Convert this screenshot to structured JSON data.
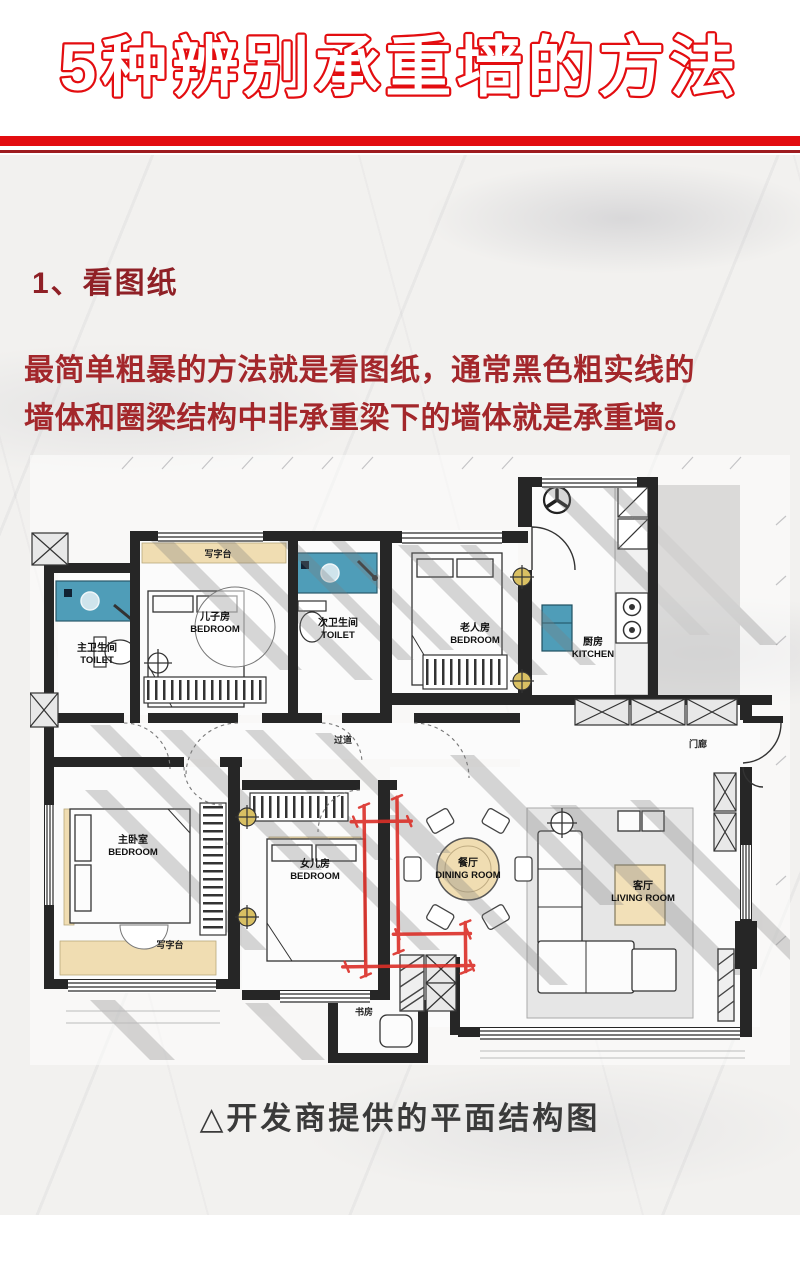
{
  "header": {
    "title": "5种辨别承重墙的方法"
  },
  "section": {
    "heading": "1、看图纸",
    "body_line1": "最简单粗暴的方法就是看图纸，通常黑色粗实线的",
    "body_line2": "墙体和圈梁结构中非承重梁下的墙体就是承重墙。",
    "caption": "△开发商提供的平面结构图"
  },
  "colors": {
    "accent_red": "#e30d10",
    "divider_dark_red": "#9e1c20",
    "heading_red": "#8f2026",
    "body_red": "#a3272b",
    "caption_gray": "#3a3a3a",
    "plan_wall_black": "#262626",
    "plan_fixture_blue": "#4f9db8",
    "plan_wood_tan": "#f0ddb2",
    "annotation_red": "#db2f28"
  },
  "floorplan": {
    "rooms": {
      "toilet_master": {
        "zh": "主卫生间",
        "en": "TOILET"
      },
      "bedroom_son": {
        "zh": "儿子房",
        "en": "BEDROOM"
      },
      "toilet_second": {
        "zh": "次卫生间",
        "en": "TOILET"
      },
      "bedroom_elder": {
        "zh": "老人房",
        "en": "BEDROOM"
      },
      "kitchen": {
        "zh": "厨房",
        "en": "KITCHEN"
      },
      "bedroom_master": {
        "zh": "主卧室",
        "en": "BEDROOM"
      },
      "bedroom_daughter": {
        "zh": "女儿房",
        "en": "BEDROOM"
      },
      "dining": {
        "zh": "餐厅",
        "en": "DINING ROOM"
      },
      "living": {
        "zh": "客厅",
        "en": "LIVING ROOM"
      }
    },
    "annotations": {
      "desk_top": "写字台",
      "desk_bottom": "写字台",
      "corridor": "过道",
      "porch": "门廊",
      "study": "书房"
    }
  }
}
